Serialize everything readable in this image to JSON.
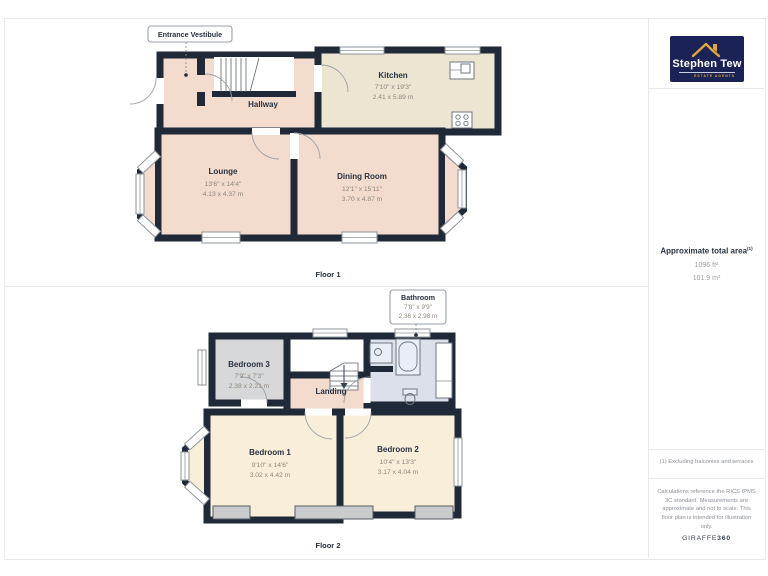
{
  "floor1": {
    "label": "Floor 1",
    "callout": {
      "title": "Entrance Vestibule"
    },
    "rooms": {
      "hallway": {
        "name": "Hallway"
      },
      "kitchen": {
        "name": "Kitchen",
        "dims_ft": "7'10\" x 19'3\"",
        "dims_m": "2.41 x 5.89 m"
      },
      "lounge": {
        "name": "Lounge",
        "dims_ft": "13'6\" x 14'4\"",
        "dims_m": "4.13 x 4.37 m"
      },
      "dining": {
        "name": "Dining Room",
        "dims_ft": "12'1\" x 15'11\"",
        "dims_m": "3.70 x 4.87 m"
      }
    }
  },
  "floor2": {
    "label": "Floor 2",
    "callout": {
      "title": "Bathroom",
      "dims_ft": "7'8\" x 9'9\"",
      "dims_m": "2.36 x 2.98 m"
    },
    "rooms": {
      "bedroom3": {
        "name": "Bedroom 3",
        "dims_ft": "7'9\" x 7'3\"",
        "dims_m": "2.38 x 2.21 m"
      },
      "landing": {
        "name": "Landing"
      },
      "bedroom1": {
        "name": "Bedroom 1",
        "dims_ft": "9'10\" x 14'6\"",
        "dims_m": "3.02 x 4.42 m"
      },
      "bedroom2": {
        "name": "Bedroom 2",
        "dims_ft": "10'4\" x 13'3\"",
        "dims_m": "3.17 x 4.04 m"
      }
    }
  },
  "sidebar": {
    "logo": {
      "name": "Stephen Tew",
      "tagline": "ESTATE AGENTS"
    },
    "area": {
      "title": "Approximate total area",
      "superscript": "(1)",
      "imperial": "1096 ft²",
      "metric": "101.9 m²"
    },
    "note": "(1) Excluding balconies and terraces",
    "disclaimer": "Calculations reference the RICS IPMS 3C standard. Measurements are approximate and not to scale. This floor plan is intended for illustration only.",
    "brand_normal": "GIRAFFE",
    "brand_bold": "360"
  },
  "colors": {
    "wall": "#1f2937",
    "room_pink": "#f3dbce",
    "room_cream_kitchen": "#ece5d2",
    "room_cream_bedroom": "#f9eeda",
    "room_gray": "#d7d8da",
    "room_blue": "#dce0eb",
    "logo_navy": "#1b2256",
    "logo_gold": "#e2a83d"
  }
}
